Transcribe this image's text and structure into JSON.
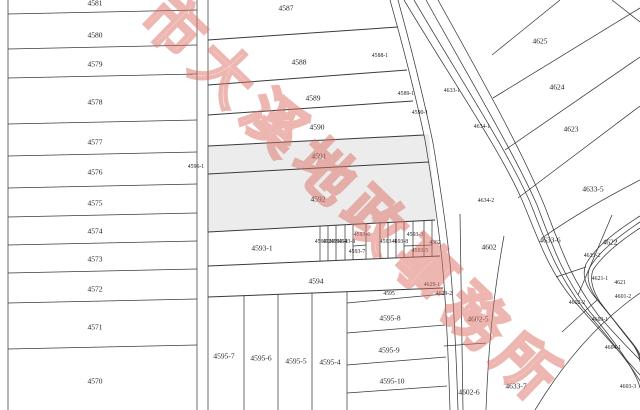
{
  "map": {
    "line_color": "#3a3a3a",
    "shade_color": "#ececec",
    "watermark": {
      "text": "市大溪地政事務所",
      "color": "#dd7064"
    },
    "labels": [
      {
        "t": "4581",
        "x": 95,
        "y": 3,
        "s": "md"
      },
      {
        "t": "4580",
        "x": 95,
        "y": 35,
        "s": "md"
      },
      {
        "t": "4579",
        "x": 95,
        "y": 64,
        "s": "md"
      },
      {
        "t": "4578",
        "x": 95,
        "y": 102,
        "s": "md"
      },
      {
        "t": "4577",
        "x": 95,
        "y": 142,
        "s": "md"
      },
      {
        "t": "4576",
        "x": 95,
        "y": 172,
        "s": "md"
      },
      {
        "t": "4575",
        "x": 95,
        "y": 203,
        "s": "md"
      },
      {
        "t": "4574",
        "x": 95,
        "y": 231,
        "s": "md"
      },
      {
        "t": "4573",
        "x": 95,
        "y": 259,
        "s": "md"
      },
      {
        "t": "4572",
        "x": 95,
        "y": 289,
        "s": "md"
      },
      {
        "t": "4571",
        "x": 95,
        "y": 327,
        "s": "md"
      },
      {
        "t": "4570",
        "x": 95,
        "y": 381,
        "s": "md"
      },
      {
        "t": "4587",
        "x": 286,
        "y": 8,
        "s": "md"
      },
      {
        "t": "4588",
        "x": 299,
        "y": 62,
        "s": "md"
      },
      {
        "t": "4589",
        "x": 313,
        "y": 98,
        "s": "md"
      },
      {
        "t": "4590",
        "x": 317,
        "y": 127,
        "s": "md"
      },
      {
        "t": "4591",
        "x": 319,
        "y": 156,
        "s": "md"
      },
      {
        "t": "4592",
        "x": 318,
        "y": 199,
        "s": "md"
      },
      {
        "t": "4593-1",
        "x": 262,
        "y": 248,
        "s": "md"
      },
      {
        "t": "4594",
        "x": 316,
        "y": 281,
        "s": "md"
      },
      {
        "t": "4595",
        "x": 389,
        "y": 295,
        "s": "sm"
      },
      {
        "t": "4595-7",
        "x": 224,
        "y": 356,
        "s": "md"
      },
      {
        "t": "4595-6",
        "x": 261,
        "y": 358,
        "s": "md"
      },
      {
        "t": "4595-5",
        "x": 296,
        "y": 361,
        "s": "md"
      },
      {
        "t": "4595-4",
        "x": 330,
        "y": 362,
        "s": "md"
      },
      {
        "t": "4595-8",
        "x": 390,
        "y": 318,
        "s": "md"
      },
      {
        "t": "4595-9",
        "x": 389,
        "y": 350,
        "s": "md"
      },
      {
        "t": "4595-10",
        "x": 392,
        "y": 381,
        "s": "md"
      },
      {
        "t": "4593-2",
        "x": 323,
        "y": 243,
        "s": "sm"
      },
      {
        "t": "4593-9",
        "x": 331,
        "y": 243,
        "s": "sm"
      },
      {
        "t": "4593-4",
        "x": 339,
        "y": 243,
        "s": "sm"
      },
      {
        "t": "4593-8",
        "x": 347,
        "y": 243,
        "s": "sm"
      },
      {
        "t": "4593-6",
        "x": 362,
        "y": 236,
        "s": "sm"
      },
      {
        "t": "4593-7",
        "x": 357,
        "y": 253,
        "s": "sm"
      },
      {
        "t": "4593-4",
        "x": 388,
        "y": 243,
        "s": "sm"
      },
      {
        "t": "4593-8",
        "x": 400,
        "y": 243,
        "s": "sm"
      },
      {
        "t": "4593-3",
        "x": 415,
        "y": 236,
        "s": "sm"
      },
      {
        "t": "4593-5",
        "x": 420,
        "y": 252,
        "s": "sm"
      },
      {
        "t": "4362",
        "x": 435,
        "y": 244,
        "s": "sm"
      },
      {
        "t": "4588-1",
        "x": 380,
        "y": 57,
        "s": "sm"
      },
      {
        "t": "4589-1",
        "x": 406,
        "y": 95,
        "s": "sm"
      },
      {
        "t": "4590-1",
        "x": 420,
        "y": 114,
        "s": "sm"
      },
      {
        "t": "4633-1",
        "x": 452,
        "y": 92,
        "s": "sm"
      },
      {
        "t": "4634-1",
        "x": 482,
        "y": 128,
        "s": "sm"
      },
      {
        "t": "4634-2",
        "x": 486,
        "y": 202,
        "s": "sm"
      },
      {
        "t": "4596-1",
        "x": 196,
        "y": 168,
        "s": "sm"
      },
      {
        "t": "4629-1",
        "x": 432,
        "y": 286,
        "s": "sm"
      },
      {
        "t": "4629-2",
        "x": 444,
        "y": 295,
        "s": "sm"
      },
      {
        "t": "4625",
        "x": 540,
        "y": 41,
        "s": "md"
      },
      {
        "t": "4624",
        "x": 557,
        "y": 87,
        "s": "md"
      },
      {
        "t": "4623",
        "x": 571,
        "y": 129,
        "s": "md"
      },
      {
        "t": "4633-5",
        "x": 593,
        "y": 189,
        "s": "md"
      },
      {
        "t": "4633-6",
        "x": 550,
        "y": 240,
        "s": "md"
      },
      {
        "t": "4622",
        "x": 610,
        "y": 242,
        "s": "md"
      },
      {
        "t": "4602",
        "x": 489,
        "y": 247,
        "s": "md"
      },
      {
        "t": "4602-5",
        "x": 478,
        "y": 319,
        "s": "md"
      },
      {
        "t": "4602-6",
        "x": 469,
        "y": 392,
        "s": "md"
      },
      {
        "t": "4633-7",
        "x": 516,
        "y": 386,
        "s": "md"
      },
      {
        "t": "4633-2",
        "x": 592,
        "y": 257,
        "s": "sm"
      },
      {
        "t": "4621-1",
        "x": 600,
        "y": 280,
        "s": "sm"
      },
      {
        "t": "4621",
        "x": 620,
        "y": 284,
        "s": "sm"
      },
      {
        "t": "4601-2",
        "x": 623,
        "y": 298,
        "s": "sm"
      },
      {
        "t": "4602-2",
        "x": 577,
        "y": 304,
        "s": "sm"
      },
      {
        "t": "4603-1",
        "x": 600,
        "y": 321,
        "s": "sm"
      },
      {
        "t": "4604-1",
        "x": 613,
        "y": 349,
        "s": "sm"
      },
      {
        "t": "4603-3",
        "x": 628,
        "y": 388,
        "s": "sm"
      }
    ]
  }
}
